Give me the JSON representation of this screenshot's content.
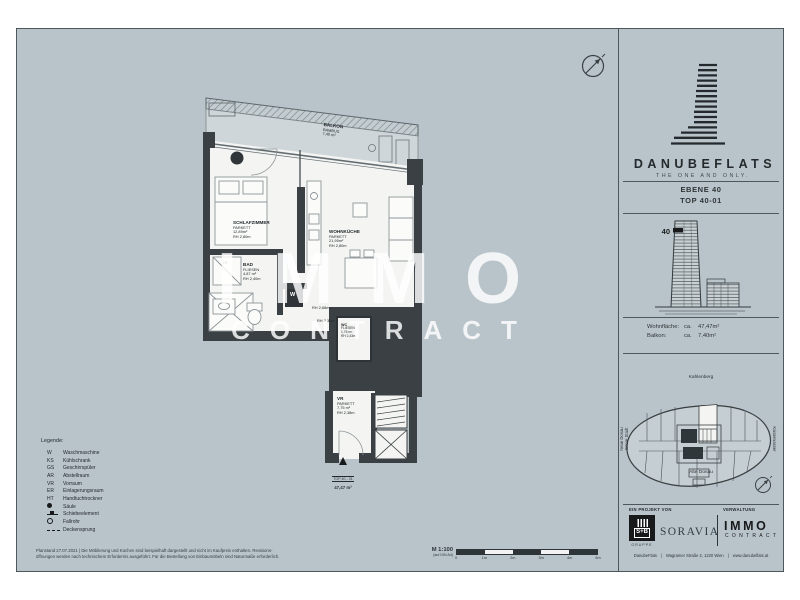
{
  "colors": {
    "sheet_bg": "#b9c4ca",
    "wall": "#3a4043",
    "room": "#f4f5f3",
    "balcony": "#cfd6d9",
    "ink": "#2e3437"
  },
  "brand": {
    "name": "DANUBEFLATS",
    "tagline": "THE ONE AND ONLY.",
    "level": "EBENE  40",
    "unit": "TOP 40-01",
    "floor_badge": "40"
  },
  "stats": {
    "rows": [
      {
        "label": "Wohnfläche:",
        "ca": "ca.",
        "value": "47,47m²"
      },
      {
        "label": "Balkon:",
        "ca": "ca.",
        "value": "7,40m²"
      }
    ]
  },
  "site": {
    "north": "Kahlenberg",
    "south": "Alte Donau",
    "east": "Kaiserwasser",
    "west_line1": "Neue Donau",
    "west_line2": "Innere Stadt"
  },
  "partners": {
    "project_label": "EIN PROJEKT VON",
    "management_label": "VERWALTUNG",
    "sb_name": "S+B",
    "sb_sub": "GRUPPE",
    "soravia": "SORAVIA",
    "immo_name": "IMMO",
    "immo_sub": "CONTRACT"
  },
  "footer_contact": {
    "items": [
      "DanubeFlats",
      "Wagramer Straße 2, 1220 Wien",
      "www.danubeflats.at"
    ],
    "sep": "|"
  },
  "plan": {
    "rooms": [
      {
        "name": "BALKON",
        "floor": "BAMBUS",
        "area": "7,40 m²"
      },
      {
        "name": "SCHLAFZIMMER",
        "floor": "PARKETT",
        "area": "12,89m²",
        "height": "RH 2,80m"
      },
      {
        "name": "WOHNKÜCHE",
        "floor": "PARKETT",
        "area": "21,95m²",
        "height": "RH 2,80m"
      },
      {
        "name": "BAD",
        "floor": "FLIESEN",
        "area": "4,87 m²",
        "height": "RH 2,40m"
      },
      {
        "name": "WC",
        "floor": "FLIESEN",
        "area": "1,76 m²",
        "height": "RH 2,43m"
      },
      {
        "name": "VR",
        "floor": "PARKETT",
        "area": "7,75 m²",
        "height": "RH 2,38m"
      }
    ],
    "annotations": {
      "washer": "W",
      "towel_radiator": "HT",
      "rh_corridor": "RH 2,68m",
      "rh_corridor2": "RH 2,38m",
      "entrance_unit": "TOP 40 - 01",
      "entrance_area": "47,47 m²"
    },
    "watermark": {
      "line1": "IMMO",
      "line2": "CONTRACT"
    }
  },
  "legend": {
    "title": "Legende:",
    "items": [
      {
        "key": "W",
        "label": "Waschmaschine"
      },
      {
        "key": "KS",
        "label": "Kühlschrank"
      },
      {
        "key": "GS",
        "label": "Geschirrspüler"
      },
      {
        "key": "AR",
        "label": "Abstellraum"
      },
      {
        "key": "VR",
        "label": "Vorraum"
      },
      {
        "key": "ER",
        "label": "Einlagerungsraum"
      },
      {
        "key": "HT",
        "label": "Handtuchtrockner"
      },
      {
        "key": "",
        "icon": "saeule-dot",
        "label": "Säule"
      },
      {
        "key": "",
        "icon": "schiebeelement",
        "label": "Schiebeelement"
      },
      {
        "key": "",
        "icon": "fallrohr-circle",
        "label": "Fallrohr"
      },
      {
        "key": "",
        "icon": "deckensprung-line",
        "label": "Deckensprung"
      }
    ]
  },
  "scale": {
    "label": "M 1:100",
    "sub": "(auf DIN A4)",
    "ticks": [
      "0",
      "1m",
      "2m",
      "3m",
      "4m",
      "5m"
    ]
  },
  "disclaimer": {
    "line1": "Planstand 27.07.2021  |  Die Möblierung und Küchen sind beispielhaft dargestellt und nicht im Kaufpreis enthalten. Revisions-",
    "line2": "öffnungen werden nach technischem Erfordernis ausgeführt. Für die Bestellung von Einbaumöbeln sind Naturmaße erforderlich."
  }
}
